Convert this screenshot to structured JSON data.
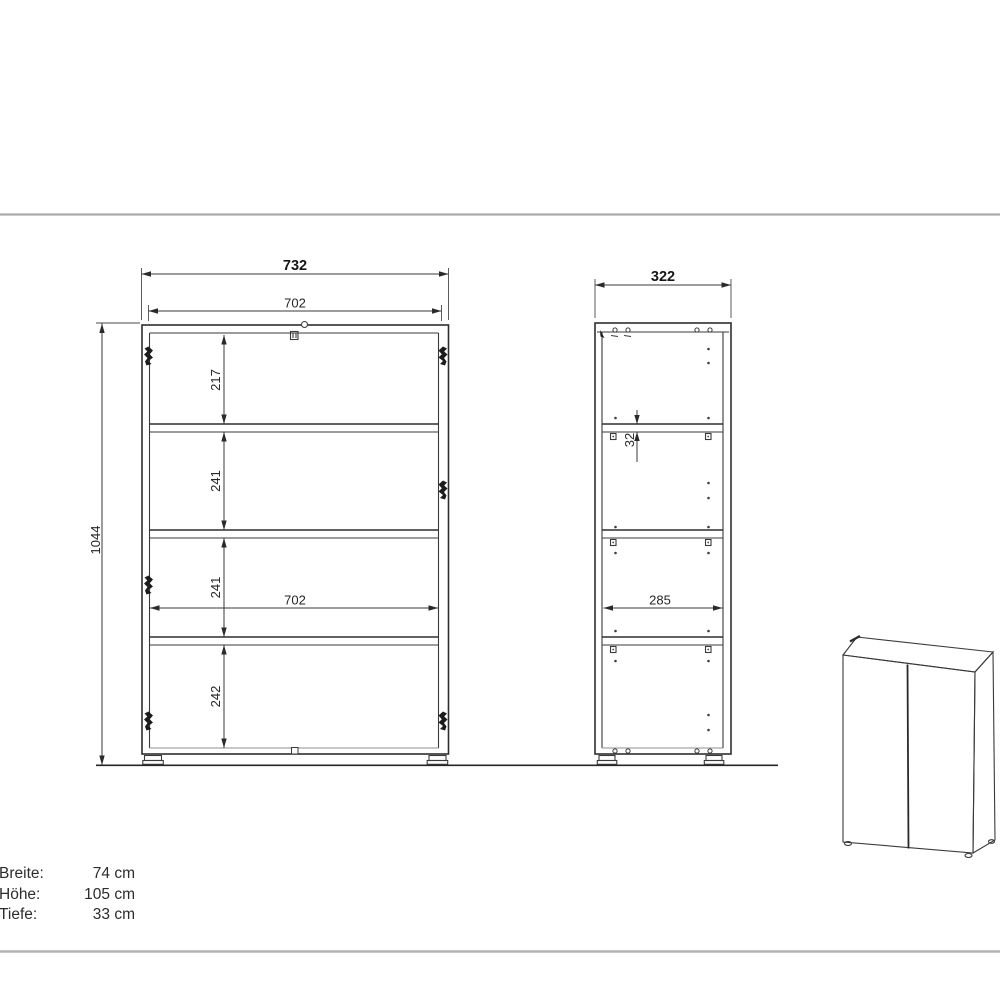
{
  "drawing": {
    "front_view": {
      "outer_width": "732",
      "inner_width": "702",
      "total_height": "1044",
      "sections": [
        "217",
        "241",
        "241",
        "242"
      ],
      "mid_inner_width": "702"
    },
    "side_view": {
      "outer_depth": "322",
      "shelf_thickness": "32",
      "inner_depth": "285"
    },
    "units": "mm"
  },
  "specs": {
    "rows": [
      {
        "label": "Breite:",
        "value": "74 cm"
      },
      {
        "label": "Höhe:",
        "value": "105 cm"
      },
      {
        "label": "Tiefe:",
        "value": "33 cm"
      }
    ]
  },
  "colors": {
    "line": "#3a3a3a",
    "separator": "#ababab",
    "background": "#ffffff"
  }
}
